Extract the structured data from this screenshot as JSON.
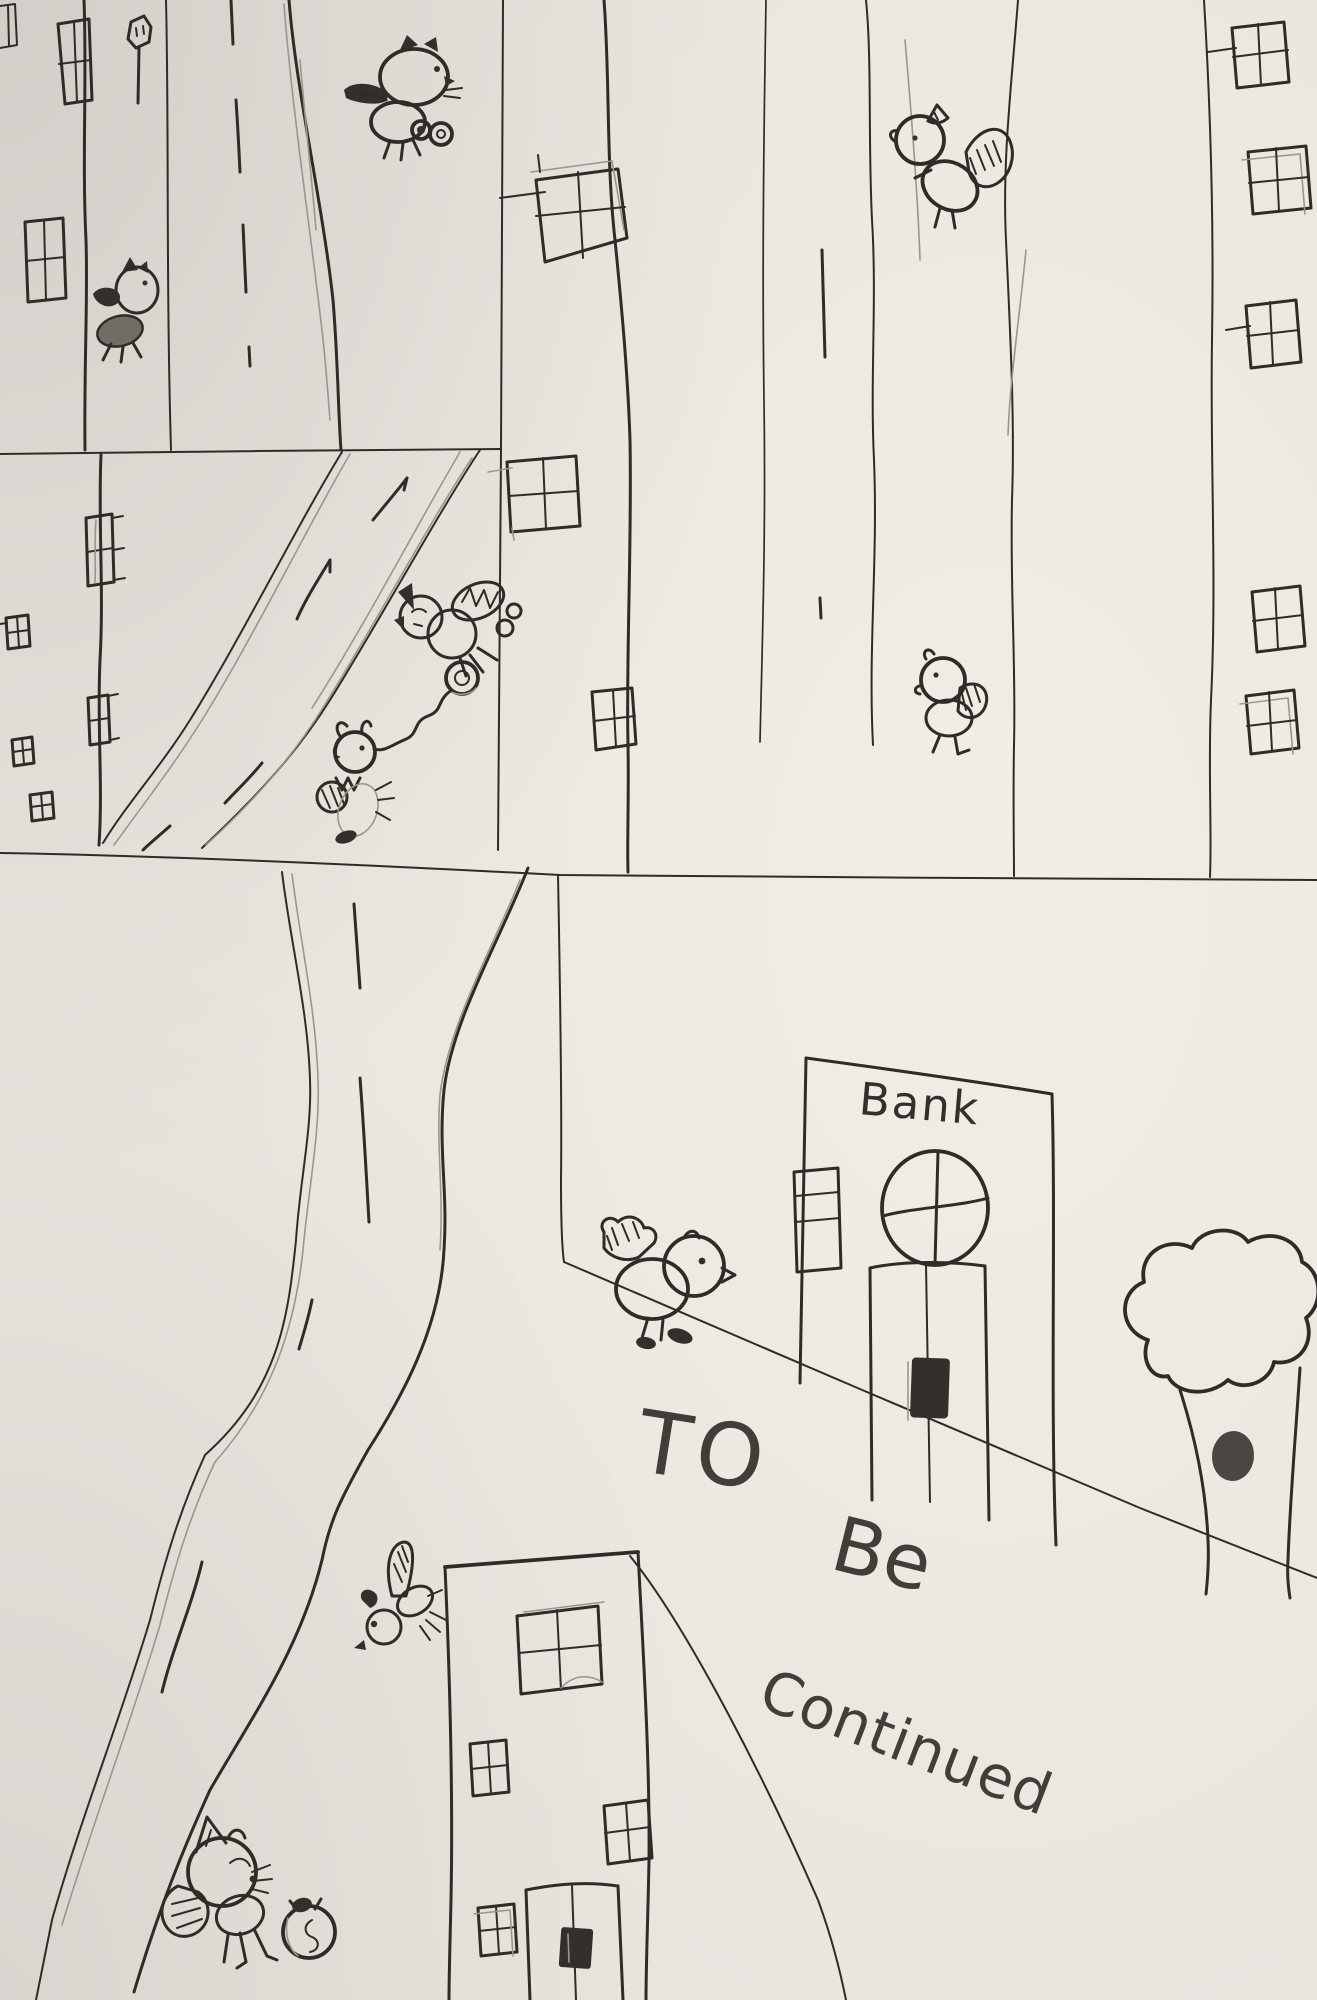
{
  "texts": {
    "bank_sign": "Bank",
    "caption_to": "TO",
    "caption_be": "Be",
    "caption_continued": "Continued"
  },
  "palette": {
    "paper": "#e9e5df",
    "ink": "#2f2c28",
    "pencil": "#9b958d",
    "shading_gray": "#716c66",
    "dark_fill": "#33302c"
  },
  "figures": [
    "cat-flying-with-loot",
    "bird-with-bag",
    "squirrel",
    "bird-walking",
    "bird-with-ball",
    "small-creature-with-ball",
    "bird-at-bank",
    "flying-bee-bird",
    "cat-with-money-bag",
    "money-bag",
    "bank-building",
    "tree-with-knot",
    "city-buildings",
    "roads"
  ]
}
